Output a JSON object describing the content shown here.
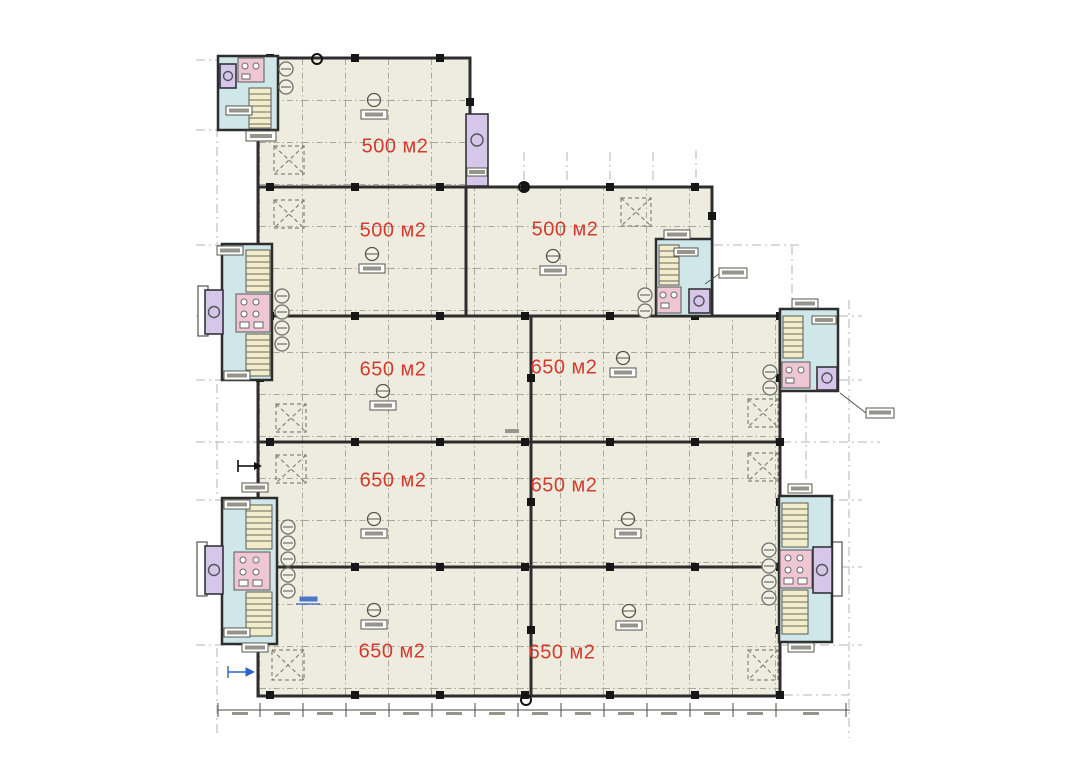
{
  "plan": {
    "type": "architectural-floor-plan",
    "area_unit": "м2",
    "rooms": [
      {
        "id": "room-1",
        "row": 1,
        "col": "left",
        "label": "500 м2"
      },
      {
        "id": "room-2",
        "row": 2,
        "col": "left",
        "label": "500 м2"
      },
      {
        "id": "room-3",
        "row": 2,
        "col": "right",
        "label": "500 м2"
      },
      {
        "id": "room-4",
        "row": 3,
        "col": "left",
        "label": "650 м2"
      },
      {
        "id": "room-5",
        "row": 3,
        "col": "right",
        "label": "650 м2"
      },
      {
        "id": "room-6",
        "row": 4,
        "col": "left",
        "label": "650 м2"
      },
      {
        "id": "room-7",
        "row": 4,
        "col": "right",
        "label": "650 м2"
      },
      {
        "id": "room-8",
        "row": 5,
        "col": "left",
        "label": "650 м2"
      },
      {
        "id": "room-9",
        "row": 5,
        "col": "right",
        "label": "650 м2"
      }
    ],
    "colors": {
      "label_red": "#d43a2e",
      "room_fill": "#edecdf",
      "wall": "#2d2d2d",
      "utility_fill": "#cfe7e9",
      "elevator_fill": "#d6c6ea",
      "stair_fill": "#f2ecca",
      "fixture_pink": "#efc6d6",
      "grid_line": "#a9a99a",
      "exterior_line": "#b6b6be",
      "annotation_blue": "#2f62c9"
    }
  }
}
